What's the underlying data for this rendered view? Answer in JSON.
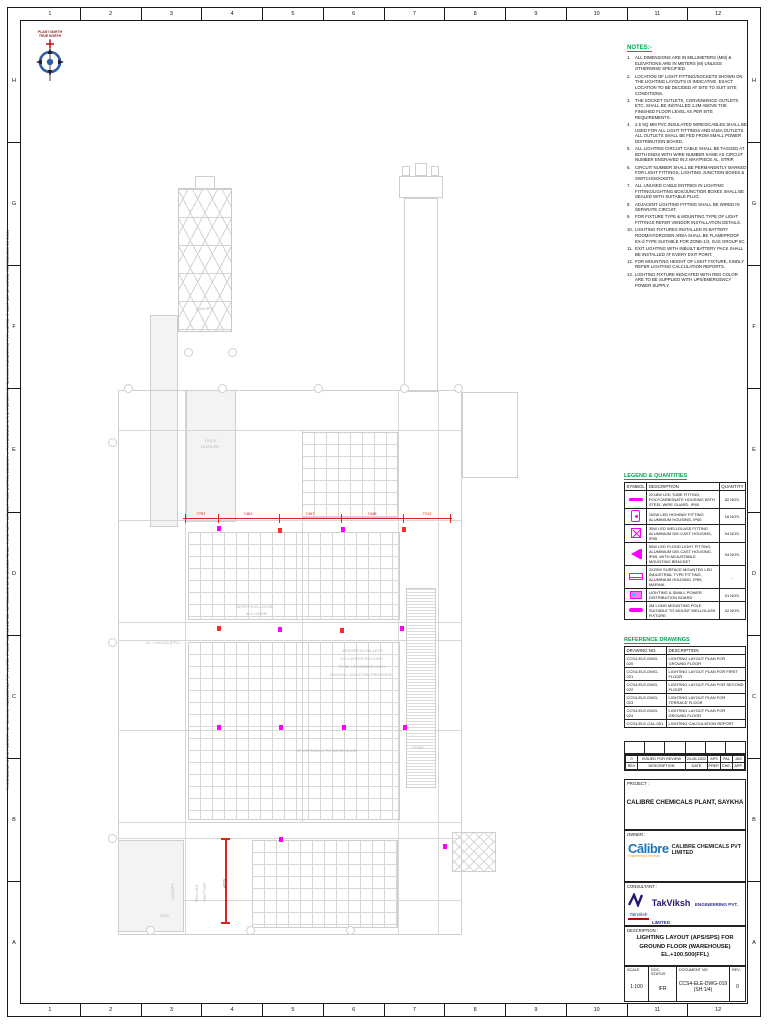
{
  "frame": {
    "columns": [
      "1",
      "2",
      "3",
      "4",
      "5",
      "6",
      "7",
      "8",
      "9",
      "10",
      "11",
      "12"
    ],
    "rows": [
      "H",
      "G",
      "F",
      "E",
      "D",
      "C",
      "B",
      "A"
    ],
    "side_note": "THIS DRAWING IS THE PROPERTY OF TAKVIKSH ENGINEERING PVT. LIMITED. IT MUST NOT BE COPIED, REPRODUCED OR DISCLOSED TO ANY THIRD PARTY WITHOUT PRIOR WRITTEN CONSENT. — THIS DRAWING IS THE PROPERTY OF TAKVIKSH ENGINEERING PVT. LIMITED. IT MUST NOT BE COPIED, REPRODUCED OR DISCLOSED TO ANY THIRD PARTY WITHOUT PRIOR WRITTEN CONSENT."
  },
  "compass": {
    "caption_line1": "PLANT NORTH",
    "caption_line2": "TRUE NORTH"
  },
  "notes": {
    "title": "NOTES:-",
    "items": [
      "ALL DIMENSIONS ARE IN MILLIMETERS (MM) & ELEVATIONS ARE IN METERS (M) UNLESS OTHERWISE SPECIFIED.",
      "LOCATION OF LIGHT FITTING/SOCKETS SHOWN ON THE LIGHTING LAYOUTS IS INDICATIVE. EXACT LOCATION TO BE DECIDED AT SITE TO SUIT SITE CONDITIONS.",
      "THE SOCKET OUTLETS, CONVENIENCE OUTLETS ETC. SHALL BE INSTALLED 1.2M ABOVE THE FINISHED FLOOR LEVEL AS PER SITE REQUIREMENTS.",
      "2.5 SQ MM PVC INSULATED WIRES/CABLES SHALL BE USED FOR ALL LIGHT FITTINGS AND 6/16A OUTLETS. ALL OUTLETS SHALL BE FED FROM SMALL POWER DISTRIBUTION BOARD.",
      "ALL LIGHTING CIRCUIT CABLE SHALL BE TAGGED AT BOTH ENDS WITH WIRE NUMBER SAME AS CIRCUIT NUMBER ENGRAVED IN 2 WAY/PIECE AL. STRIP.",
      "CIRCUIT NUMBER SHALL BE PERMANENTLY MARKED FOR LIGHT FITTINGS, LIGHTING JUNCTION BOXES & SWITCH/SOCKETS.",
      "ALL UNUSED CABLE ENTRIES IN LIGHTING FITTING/LIGHTING BOX/JUNCTION BOXES SHALL BE SEALED WITH SUITABLE PLUG.",
      "ADJACENT LIGHTING FITTING SHALL BE WIRED IN SEPARATE CIRCUIT.",
      "FOR FIXTURE TYPE & MOUNTING TYPE OF LIGHT FITTINGS REFER VENDOR INSTALLATION DETAILS.",
      "LIGHTING FIXTURES INSTALLED IN BATTERY ROOM/HYDROGEN AREA SHALL BE FLAMEPROOF EX-d TYPE SUITABLE FOR ZONE-1/2, GAS GROUP IIC.",
      "EXIT LIGHTING WITH INBUILT BATTERY PACK SHALL BE INSTALLED AT EVERY EXIT POINT.",
      "FOR MOUNTING HEIGHT OF LIGHT FIXTURE, KINDLY REFER LIGHTING CALCULATION REPORTS.",
      "LIGHTING FIXTURE INDICATED WITH RED COLOR ARE TO BE SUPPLIED WITH UPS/EMERGENCY POWER SUPPLY."
    ]
  },
  "legend": {
    "title": "LEGEND & QUANTITIES",
    "headers": [
      "SYMBOL",
      "DESCRIPTION",
      "QUANTITY"
    ],
    "rows": [
      {
        "symbol": "linear-fixture",
        "description": "2X18W LED TUBE FITTING, POLYCARBONATE HOUSING WITH STEEL WIRE GUARD, IP65",
        "quantity": "82 NOS."
      },
      {
        "symbol": "highbay-fixture",
        "description": "100W LED HIGHBAY FITTING ALUMINIUM HOUSING, IP65",
        "quantity": "16 NOS."
      },
      {
        "symbol": "wellglass-fixture",
        "description": "30W LED WELLGLASS FITTING ALUMINIUM DIE-CAST HOUSING, IP65",
        "quantity": "04 NOS."
      },
      {
        "symbol": "floodlight-fixture",
        "description": "50W LED FLOOD LIGHT FITTING, ALUMINIUM DIE-CAST HOUSING, IP65, WITH ADJUSTABLE MOUNTING BRACKET",
        "quantity": "04 NOS."
      },
      {
        "symbol": "surface-led-fixture",
        "description": "2X20W SURFACE MOUNTED LED INDUSTRIAL TYPE FITTING, ALUMINIUM HOUSING, IP65, MARINA",
        "quantity": "-"
      },
      {
        "symbol": "distribution-board",
        "description": "LIGHTING & SMALL POWER DISTRIBUTION BOARD",
        "quantity": "01 NOS."
      },
      {
        "symbol": "mounting-pole",
        "description": "2M LONG MOUNTING POLE SUITABLE TO MOUNT WELLGLASS FIXTURE",
        "quantity": "02 NOS."
      }
    ]
  },
  "reference": {
    "title": "REFERENCE DRAWINGS",
    "headers": [
      "DRAWING NO.",
      "DESCRIPTION"
    ],
    "rows": [
      {
        "no": "CCS4-ELE-DWG-020",
        "description": "LIGHTING LAYOUT PLAN FOR GROUND FLOOR"
      },
      {
        "no": "CCS4-ELE-DWG-021",
        "description": "LIGHTING LAYOUT PLAN FOR FIRST FLOOR"
      },
      {
        "no": "CCS4-ELE-DWG-022",
        "description": "LIGHTING LAYOUT PLAN FOR SECOND FLOOR"
      },
      {
        "no": "CCS4-ELE-DWG-023",
        "description": "LIGHTING LAYOUT PLAN FOR TERRACE FLOOR"
      },
      {
        "no": "CCS4-ELE-DWG-024",
        "description": "LIGHTING LAYOUT PLAN FOR GROUND FLOOR"
      },
      {
        "no": "CCS4-ELE-CAL-001",
        "description": "LIGHTING CALCULATION REPORT"
      }
    ]
  },
  "revision": {
    "headers": [
      "REV",
      "DESCRIPTION",
      "DATE",
      "PREP.",
      "CHE.",
      "APP."
    ],
    "current": {
      "rev": "0",
      "description": "ISSUED FOR REVIEW",
      "date": "24-06-2022",
      "prep": "APS",
      "che": "PAL",
      "app": "JAS"
    }
  },
  "title_block": {
    "project_label": "PROJECT :",
    "project_name": "CALIBRE CHEMICALS PLANT, SAYKHA",
    "owner_label": "OWNER :",
    "owner_logo_word": "Cālibre",
    "owner_tagline": "Engineering Chemistry",
    "owner_name": "CALIBRE CHEMICALS PVT LIMITED",
    "consultant_label": "CONSULTANT :",
    "consultant_mark": "TakViksh",
    "consultant_name": "TakViksh",
    "consultant_suffix": "ENGINEERING PVT. LIMITED",
    "consultant_url": "www.takviksh.com",
    "description_label": "DESCRIPTION :",
    "description_line1": "LIGHTING LAYOUT (APS/SPS) FOR",
    "description_line2": "GROUND FLOOR (WAREHOUSE) EL.+100.500(FFL)",
    "scale_label": "SCALE",
    "scale_value": "1:100",
    "doc_status_label": "DOC. STATUS",
    "doc_status_value": "IFR",
    "document_no_label": "DOCUMENT NO",
    "document_no_value": "CCS4-ELE-DWG-019 (SH:1/4)",
    "rev_label": "REV.",
    "rev_value": "0"
  },
  "colors": {
    "accent_green": "#00a651",
    "fixture_magenta": "#ff00ff",
    "emergency_red": "#ff2a2a",
    "dimension_red": "#e32119",
    "calibre_blue": "#1b75bb",
    "calibre_orange": "#f7941d",
    "takviksh_navy": "#28166f",
    "link_blue": "#0070c0"
  },
  "plan": {
    "horizontal_dimension": {
      "y": 518,
      "x1": 183,
      "x2": 452,
      "ticks": [
        185,
        218,
        279,
        341,
        403,
        450
      ],
      "labels": [
        {
          "text": "7757",
          "x": 201
        },
        {
          "text": "7463",
          "x": 248
        },
        {
          "text": "7407",
          "x": 310
        },
        {
          "text": "7448",
          "x": 372
        },
        {
          "text": "7212",
          "x": 427
        }
      ]
    },
    "vertical_dimension": {
      "x": 225,
      "y1": 838,
      "y2": 922,
      "label": "4722"
    },
    "labels": [
      {
        "text": "CANOPY",
        "x": 196,
        "y": 306,
        "rot": 0
      },
      {
        "text": "DOCK",
        "x": 205,
        "y": 438,
        "rot": 0
      },
      {
        "text": "LEVELER",
        "x": 201,
        "y": 444,
        "rot": 0
      },
      {
        "text": "EL.+100.500 (FFL)",
        "x": 146,
        "y": 640,
        "rot": 0
      },
      {
        "text": "APS/SPS IN-LOOSE",
        "x": 236,
        "y": 604,
        "rot": 0
      },
      {
        "text": "4+4 LAYER",
        "x": 246,
        "y": 611,
        "rot": 0
      },
      {
        "text": "APS/SPS IN PALLETS",
        "x": 342,
        "y": 648,
        "rot": 0
      },
      {
        "text": "4+4 LAYERS RACKING",
        "x": 340,
        "y": 656,
        "rot": 0
      },
      {
        "text": "TO BE UPGRADED WITH",
        "x": 338,
        "y": 664,
        "rot": 0
      },
      {
        "text": "RACKING SOLUTION PROVIDER",
        "x": 330,
        "y": 672,
        "rot": 0
      },
      {
        "text": "APS/SPS BULK P5 WAREHOUSE",
        "x": 296,
        "y": 748,
        "rot": 0
      },
      {
        "text": "PUMP",
        "x": 412,
        "y": 745,
        "rot": 0
      },
      {
        "text": "1100",
        "x": 160,
        "y": 913,
        "rot": 0
      },
      {
        "text": "CANOPY",
        "x": 170,
        "y": 900,
        "rot": -90
      },
      {
        "text": "ROLLING",
        "x": 194,
        "y": 902,
        "rot": -90
      },
      {
        "text": "SHUTTER",
        "x": 202,
        "y": 902,
        "rot": -90
      }
    ],
    "fixtures": [
      {
        "x": 217,
        "y": 526,
        "c": "m"
      },
      {
        "x": 278,
        "y": 528,
        "c": "r"
      },
      {
        "x": 341,
        "y": 527,
        "c": "m"
      },
      {
        "x": 402,
        "y": 527,
        "c": "r"
      },
      {
        "x": 217,
        "y": 626,
        "c": "r"
      },
      {
        "x": 278,
        "y": 627,
        "c": "m"
      },
      {
        "x": 340,
        "y": 628,
        "c": "r"
      },
      {
        "x": 400,
        "y": 626,
        "c": "m"
      },
      {
        "x": 217,
        "y": 725,
        "c": "m"
      },
      {
        "x": 279,
        "y": 725,
        "c": "m"
      },
      {
        "x": 342,
        "y": 725,
        "c": "m"
      },
      {
        "x": 403,
        "y": 725,
        "c": "m"
      },
      {
        "x": 279,
        "y": 837,
        "c": "m"
      },
      {
        "x": 443,
        "y": 844,
        "c": "m"
      }
    ],
    "bubbles": [
      [
        124,
        384
      ],
      [
        218,
        384
      ],
      [
        314,
        384
      ],
      [
        400,
        384
      ],
      [
        454,
        384
      ],
      [
        184,
        348
      ],
      [
        228,
        348
      ],
      [
        108,
        438
      ],
      [
        108,
        638
      ],
      [
        108,
        834
      ],
      [
        146,
        926
      ],
      [
        246,
        926
      ],
      [
        346,
        926
      ]
    ]
  }
}
